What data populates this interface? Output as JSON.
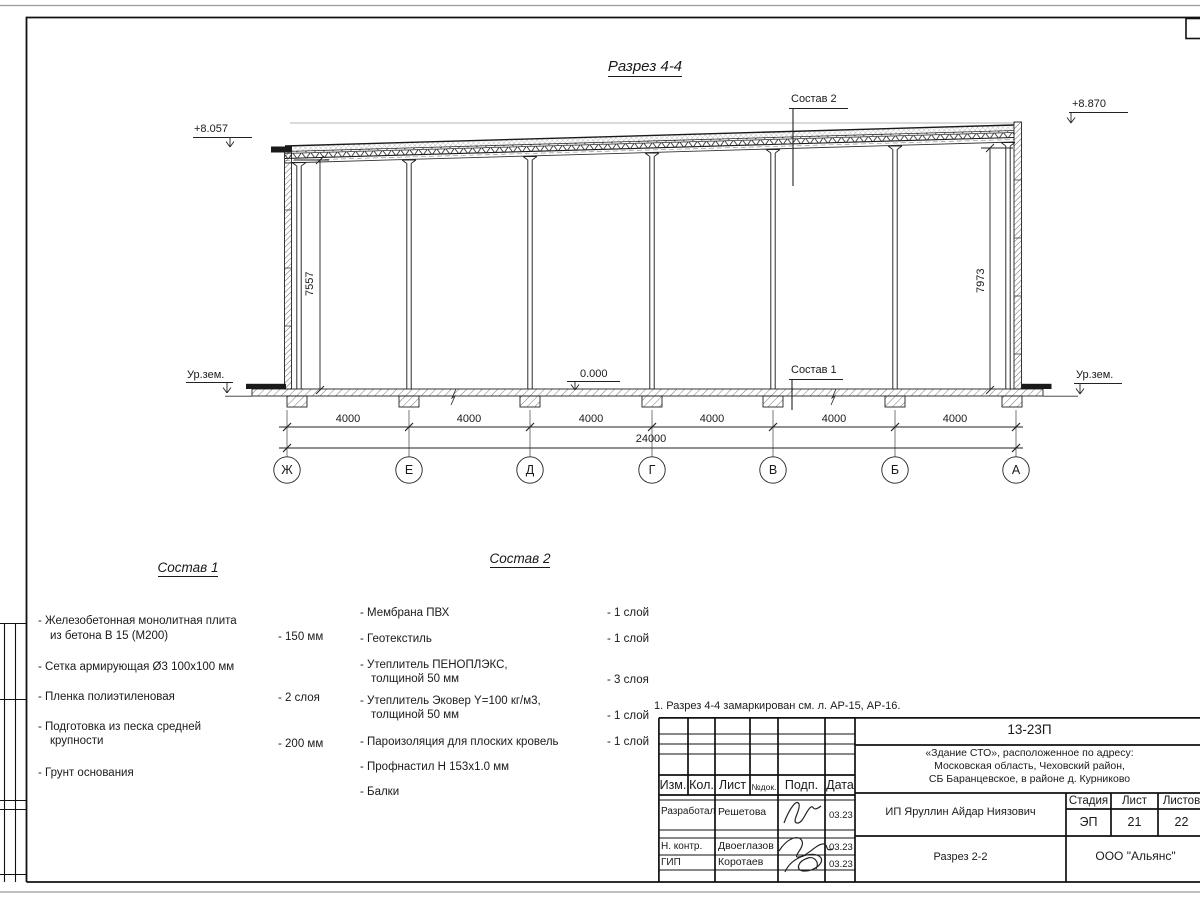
{
  "sheet": {
    "title": "Разрез 4-4",
    "note": "1. Разрез 4-4 замаркирован см. л. АР-15, АР-16."
  },
  "section": {
    "elevation_top_left": "+8.057",
    "elevation_top_right": "+8.870",
    "elevation_zero": "0.000",
    "ground_level_left": "Ур.зем.",
    "ground_level_right": "Ур.зем.",
    "height_left": "7557",
    "height_right": "7973",
    "leader_roof": "Состав 2",
    "leader_floor": "Состав 1",
    "axes": [
      "Ж",
      "Е",
      "Д",
      "Г",
      "В",
      "Б",
      "А"
    ],
    "bay_dimensions": [
      "4000",
      "4000",
      "4000",
      "4000",
      "4000",
      "4000"
    ],
    "total_dimension": "24000"
  },
  "sostav1": {
    "title": "Состав 1",
    "items": [
      {
        "line1": "- Железобетонная  монолитная плита",
        "line2": "из бетона В 15 (М200)",
        "value": "- 150 мм"
      },
      {
        "line1": "- Сетка армирующая Ø3 100х100 мм",
        "line2": "",
        "value": ""
      },
      {
        "line1": "- Пленка полиэтиленовая",
        "line2": "",
        "value": "-  2 слоя"
      },
      {
        "line1": "- Подготовка из песка средней",
        "line2": "крупности",
        "value": "- 200 мм"
      },
      {
        "line1": "- Грунт основания",
        "line2": "",
        "value": ""
      }
    ]
  },
  "sostav2": {
    "title": "Состав 2",
    "items": [
      {
        "line1": "- Мембрана ПВХ",
        "line2": "",
        "value": "- 1 слой"
      },
      {
        "line1": "- Геотекстиль",
        "line2": "",
        "value": "- 1 слой"
      },
      {
        "line1": "- Утеплитель ПЕНОПЛЭКС,",
        "line2": "толщиной 50 мм",
        "value": "- 3 слоя"
      },
      {
        "line1": "- Утеплитель Эковер Y=100 кг/м3,",
        "line2": "толщиной 50 мм",
        "value": "- 1 слой"
      },
      {
        "line1": "- Пароизоляция для плоских кровель",
        "line2": "",
        "value": "- 1 слой"
      },
      {
        "line1": "- Профнастил Н 153х1.0 мм",
        "line2": "",
        "value": ""
      },
      {
        "line1": "- Балки",
        "line2": "",
        "value": ""
      }
    ]
  },
  "titleblock": {
    "doc_number": "13-23П",
    "project_line1": "«Здание СТО», расположенное по адресу:",
    "project_line2": "Московская область, Чеховский район,",
    "project_line3": "СБ Баранцевское, в районе д. Курниково",
    "client": "ИП Яруллин Айдар Ниязович",
    "sheet_name": "Разрез 2-2",
    "organization": "ООО \"Альянс\"",
    "stage_label": "Стадия",
    "stage_value": "ЭП",
    "sheet_label": "Лист",
    "sheet_value": "21",
    "sheets_label": "Листов",
    "sheets_value": "22",
    "col_izm": "Изм.",
    "col_kol": "Кол.",
    "col_list": "Лист",
    "col_ndok": "№док.",
    "col_podp": "Подп.",
    "col_data": "Дата",
    "row1_role": "Разработал",
    "row1_name": "Решетова",
    "row1_date": "03.23",
    "row2_role": "Н. контр.",
    "row2_name": "Двоеглазов",
    "row2_date": "03.23",
    "row3_role": "ГИП",
    "row3_name": "Коротаев",
    "row3_date": "03.23"
  }
}
